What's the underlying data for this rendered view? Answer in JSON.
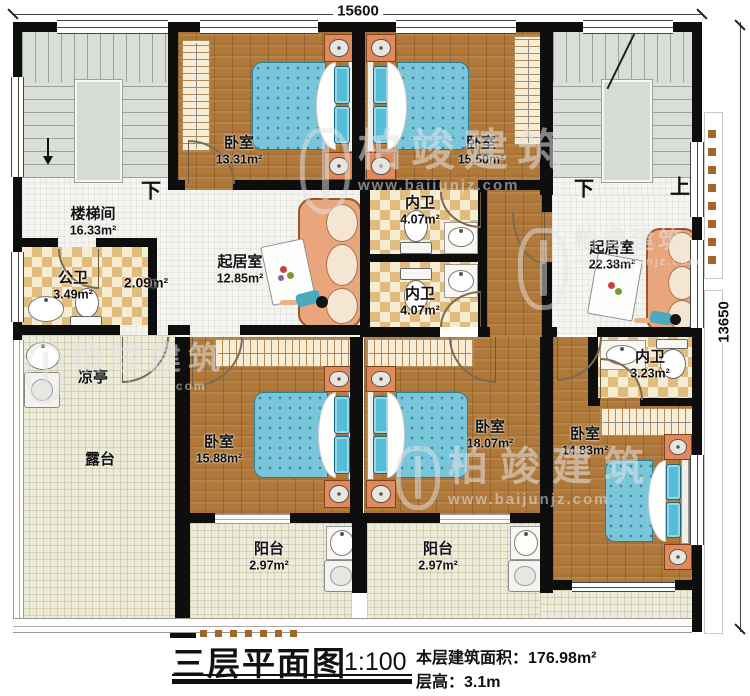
{
  "dimensions": {
    "width_mm": "15600",
    "depth_mm": "13650"
  },
  "stair_labels": {
    "left_down": "下",
    "right_down": "下",
    "right_up": "上"
  },
  "rooms": {
    "staircase": {
      "name": "楼梯间",
      "area": "16.33m²"
    },
    "public_bath": {
      "name": "公卫",
      "area": "3.49m²"
    },
    "hall": {
      "area": "2.09m²"
    },
    "living_left": {
      "name": "起居室",
      "area": "12.85m²"
    },
    "bath_inner_top": {
      "name": "内卫",
      "area": "4.07m²"
    },
    "bath_inner_bottom": {
      "name": "内卫",
      "area": "4.07m²"
    },
    "living_right": {
      "name": "起居室",
      "area": "22.38m²"
    },
    "bath_inner_right": {
      "name": "内卫",
      "area": "3.23m²"
    },
    "bedroom_top_left": {
      "name": "卧室",
      "area": "13.31m²"
    },
    "bedroom_top_mid": {
      "name": "卧室",
      "area": "15.50m²"
    },
    "bedroom_bottom_left": {
      "name": "卧室",
      "area": "15.88m²"
    },
    "bedroom_bottom_mid": {
      "name": "卧室",
      "area": "18.07m²"
    },
    "bedroom_bottom_right": {
      "name": "卧室",
      "area": "14.83m²"
    },
    "pavilion": {
      "name": "凉亭"
    },
    "terrace": {
      "name": "露台"
    },
    "balcony_left": {
      "name": "阳台",
      "area": "2.97m²"
    },
    "balcony_right": {
      "name": "阳台",
      "area": "2.97m²"
    }
  },
  "title_block": {
    "title": "三层平面图",
    "scale": "1:100",
    "area_label": "本层建筑面积：",
    "area_value": "176.98m²",
    "height_label": "层高：",
    "height_value": "3.1m"
  },
  "watermark": {
    "brand": "柏竣建筑",
    "url": "www.baijunjz.com"
  },
  "colors": {
    "wall": "#0e0e0e",
    "wood": "#b0793a",
    "tile": "#f4f4f0",
    "checker_light": "#f6ecd2",
    "checker_dark": "#e2bc7d",
    "outdoor": "#ecead8",
    "stairs": "#d9dfd6",
    "bed_blanket": "#79c6db",
    "bed_pillow": "#56bdd6",
    "furniture_accent": "#e08a5c",
    "sofa": "#e9a57b"
  }
}
